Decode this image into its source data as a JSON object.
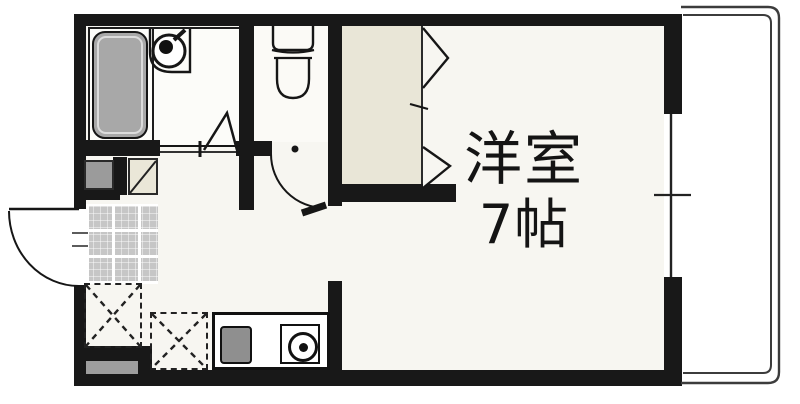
{
  "floorplan": {
    "labels": {
      "room": "洋室",
      "size": "7帖"
    },
    "fixtures": [
      "bathtub",
      "washbasin",
      "toilet",
      "folding-bath-door",
      "toilet-door",
      "closet",
      "closet-folding-door",
      "entrance-tile",
      "shoe-box",
      "washer-space",
      "refrigerator-space",
      "kitchen-counter",
      "kitchen-sink",
      "gas-stove",
      "entry-door",
      "window",
      "balcony-railing"
    ],
    "colors": {
      "wall": "#181818",
      "bathtub": "#a8a8a8",
      "closet": "#e9e6d7",
      "room_floor": "#f7f6f1",
      "entrance_tile": "#c6c6c6",
      "appliance_gray": "#8f8f8f",
      "railing": "#3c3c3c"
    }
  }
}
